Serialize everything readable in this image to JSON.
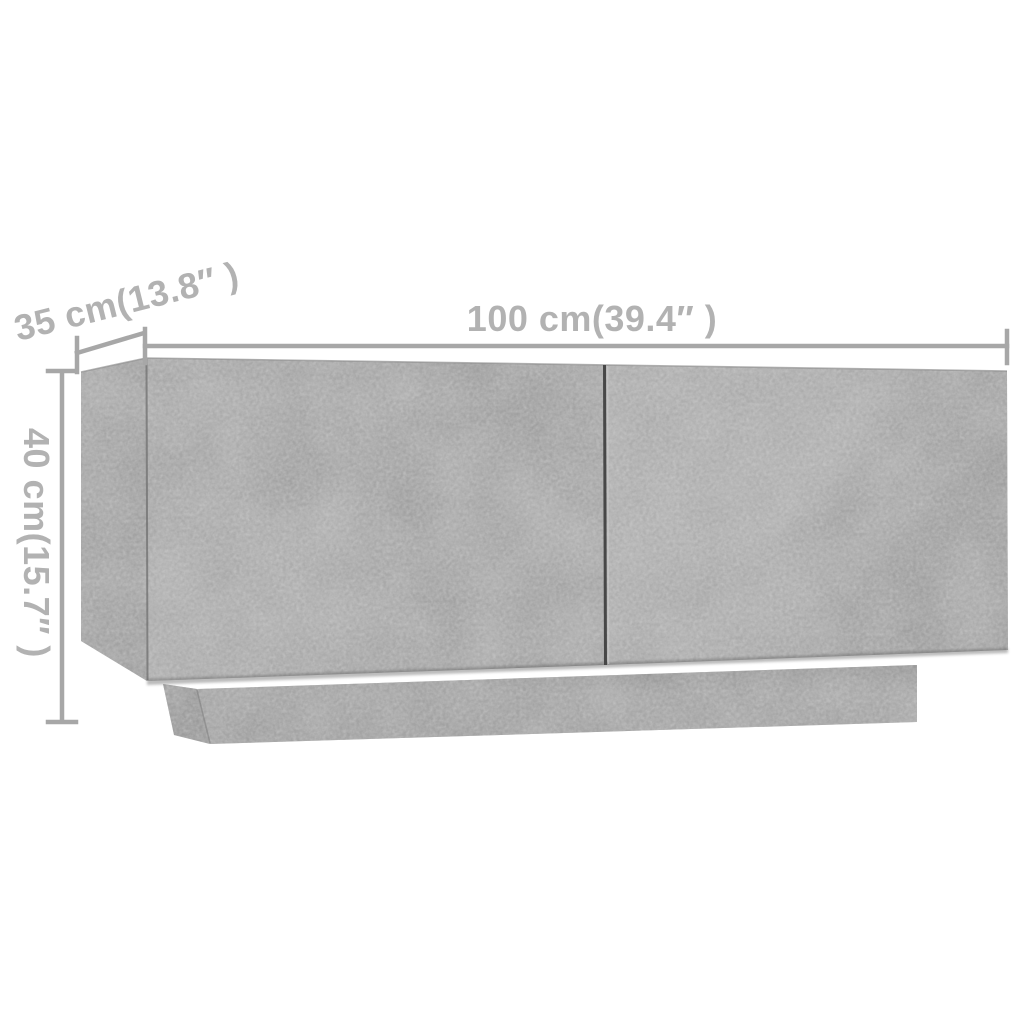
{
  "figure": {
    "type": "product-dimension-diagram",
    "subject": "tv-cabinet-concrete-gray"
  },
  "dimensions": {
    "width_label": "100 cm(39.4″ )",
    "depth_label": "35 cm(13.8″ )",
    "height_label": "40 cm(15.7″ )"
  },
  "colors": {
    "background": "#ffffff",
    "annotation_text": "#b2b2b2",
    "annotation_line": "#a7a7a7",
    "furniture_front": "#a9a9a9",
    "furniture_front_dark": "#9d9d9d",
    "furniture_side": "#a1a1a1",
    "furniture_side_dark": "#949494",
    "furniture_plinth": "#a3a3a3",
    "furniture_plinth_side": "#929292",
    "door_gap": "#474747"
  }
}
